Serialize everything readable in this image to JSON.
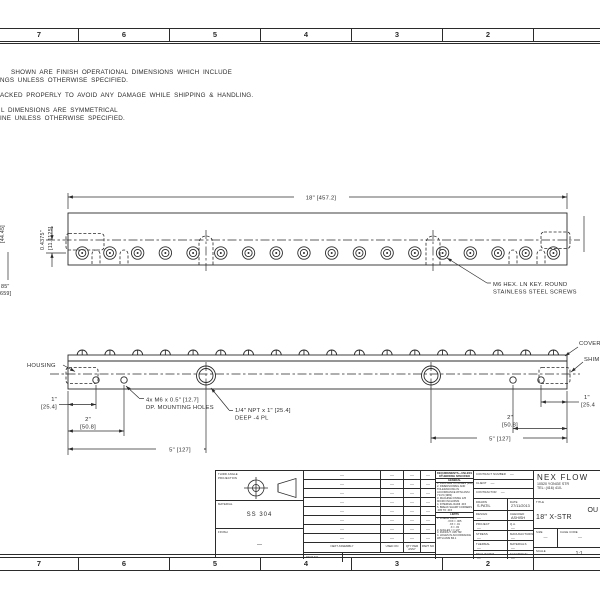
{
  "drawing": {
    "line_color": "#2b2b2b"
  },
  "zones": {
    "top": [
      "7",
      "6",
      "5",
      "4",
      "3",
      "2"
    ],
    "bottom": [
      "7",
      "6",
      "5",
      "4",
      "3",
      "2"
    ]
  },
  "notes": {
    "l1": "SHOWN ARE FINISH OPERATIONAL DIMENSIONS WHICH INCLUDE",
    "l2": "NGS UNLESS OTHERWISE SPECIFIED.",
    "l3": "ACKED PROPERLY TO AVOID ANY DAMAGE WHILE SHIPPING & HANDLING.",
    "l4": "L DIMENSIONS ARE SYMMETRICAL",
    "l5": "INE UNLESS OTHERWISE SPECIFIED."
  },
  "top_view": {
    "dim_length": "18\" [457.2]",
    "dim_offset_in": "0.4375\"",
    "dim_offset_mm": "[11.1125]",
    "dim_cut_mm": "[44.45]",
    "dim_cut_a": "85\"",
    "dim_cut_b": "659]",
    "screw_note_1": "M6 HEX. LN KEY. ROUND",
    "screw_note_2": "STAINLESS STEEL SCREWS"
  },
  "front_view": {
    "label_housing": "HOUSING",
    "label_cover": "COVER",
    "label_shim": "SHIM",
    "dim_1_in": "1\"",
    "dim_1_mm": "[25.4]",
    "dim_2_in": "2\"",
    "dim_2_mm": "[50.8]",
    "dim_5": "5\" [127]",
    "dim_1r_in": "1\"",
    "dim_1r_mm": "[25.4",
    "note_holes_1": "4x M6 x 0.5\" [12.7]",
    "note_holes_2": "DP. MOUNTING HOLES",
    "note_npt_1": "1/4\" NPT x 1\" [25.4]",
    "note_npt_2": "DEEP -4 PL"
  },
  "title_block": {
    "projection_label": "THIRD ANGLE PROJECTION",
    "material_label": "MATERIAL",
    "material_value": "SS 304",
    "finish_label": "FINISH",
    "finish_value": "—",
    "assembly": {
      "headers": [
        "NEXT ASSEMBLY",
        "USED ON",
        "QTY PER ASSY",
        "PART NO"
      ],
      "rows": [
        [
          "—",
          "—",
          "—",
          "—"
        ],
        [
          "—",
          "—",
          "—",
          "—"
        ],
        [
          "—",
          "—",
          "—",
          "—"
        ],
        [
          "—",
          "—",
          "—",
          "—"
        ],
        [
          "—",
          "—",
          "—",
          "—"
        ],
        [
          "—",
          "—",
          "—",
          "—"
        ],
        [
          "—",
          "—",
          "—",
          "—"
        ],
        [
          "—",
          "—",
          "—",
          "—"
        ]
      ],
      "part_no_label": "PART NO",
      "part_no_value": "—"
    },
    "requirements": {
      "title": "REQUIREMENTS—UNLESS OTHERWISE SPECIFIED",
      "general_heading": "GENERAL",
      "general": [
        "1. DIMS ARE IN INCHES (MM)",
        "2. DIMENSIONING AND TOLERANCING IN ACCORDANCE WITH ANSI Y14.5 (1982)",
        "3. MACHINE FINISH 125 MICRO INCH RMS",
        "4. INTERNAL RADII .015",
        "5. BREAK SHARP CORNERS .005 TO .015"
      ],
      "limits_heading": "LIMITS",
      "limits": [
        "1. LINEAR DIMS.",
        ".XXX = .005",
        ".XX = .01",
        ".X = .03",
        "2. ANGLES = ± 1/2°",
        "3. RUNOUT .005 TIR",
        "4. HOLES IN ACCORDANCE WITH ANSI B4.1"
      ]
    },
    "admin": {
      "contract_label": "CONTRACT NUMBER",
      "contract_value": "—",
      "client_label": "CLIENT",
      "client_value": "—",
      "contractor_label": "CONTRACTOR",
      "contractor_value": "—",
      "drawn_label": "DRAWN",
      "drawn_value": "S.PATIL",
      "date_label": "DATE",
      "date_value": "27/11/2013",
      "design_label": "DESIGN",
      "design_value": "—",
      "checked_label": "CHECKED",
      "checked_value": "ASHISH",
      "project_label": "PROJECT",
      "project_value": "—",
      "qa_label": "Q.A.",
      "qa_value": "—",
      "stress_label": "STRESS",
      "stress_value": "—",
      "manufacturing_label": "MANUFACTURING",
      "manufacturing_value": "—",
      "thermal_label": "THERMAL",
      "thermal_value": "—",
      "materials_label": "MATERIALS",
      "materials_value": "—",
      "mechanism_label": "MECHANISM",
      "mechanism_value": "—",
      "electrical_label": "ELECTRICAL",
      "electrical_value": "—"
    },
    "company": {
      "name": "NEX FLOW",
      "address": "10520 YONGE STR",
      "tel": "TEL: (416) 410-",
      "title_label": "TITLE",
      "title_line1": "OU",
      "title_line2": "18\" X-STR",
      "size_label": "SIZE",
      "size_value": "—",
      "cage_label": "CAGE CODE",
      "cage_value": "—",
      "scale_label": "SCALE",
      "scale_value": "1:1"
    }
  }
}
